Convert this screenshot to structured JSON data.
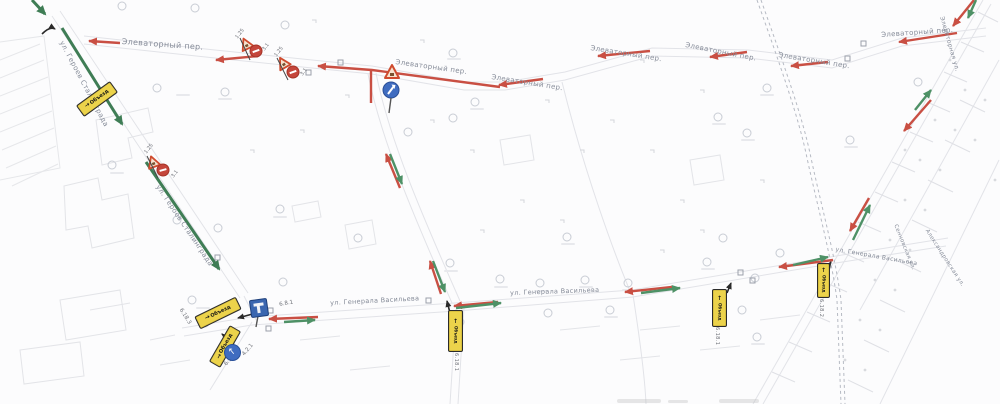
{
  "map": {
    "streets": {
      "elevatorny": "Элеваторный пер.",
      "geroev_stalingrada": "ул. Героев Сталинграда",
      "generala_vasilyeva": "ул. Генерала Васильева",
      "elevatornaya": "Элеваторная ул.",
      "sennovskaya": "Сенновская ул.",
      "aleksandrovskaya": "Александровская ул."
    },
    "signs": {
      "detour_plate_text": "Объезд",
      "codes": {
        "roadworks": "1.25",
        "no_entry": "3.1",
        "mandatory_direction": "4.2.1",
        "dead_end": "6.8.1",
        "detour_scheme_1": "6.18.1",
        "detour_scheme_2": "6.18.2",
        "detour_scheme_3": "6.18.3"
      }
    },
    "legend": {
      "closed_direction_color": "#c94f43",
      "detour_direction_color": "#4e9166",
      "temp_sign_yellow": "#ecd34b",
      "info_sign_blue": "#3a66b0"
    }
  }
}
